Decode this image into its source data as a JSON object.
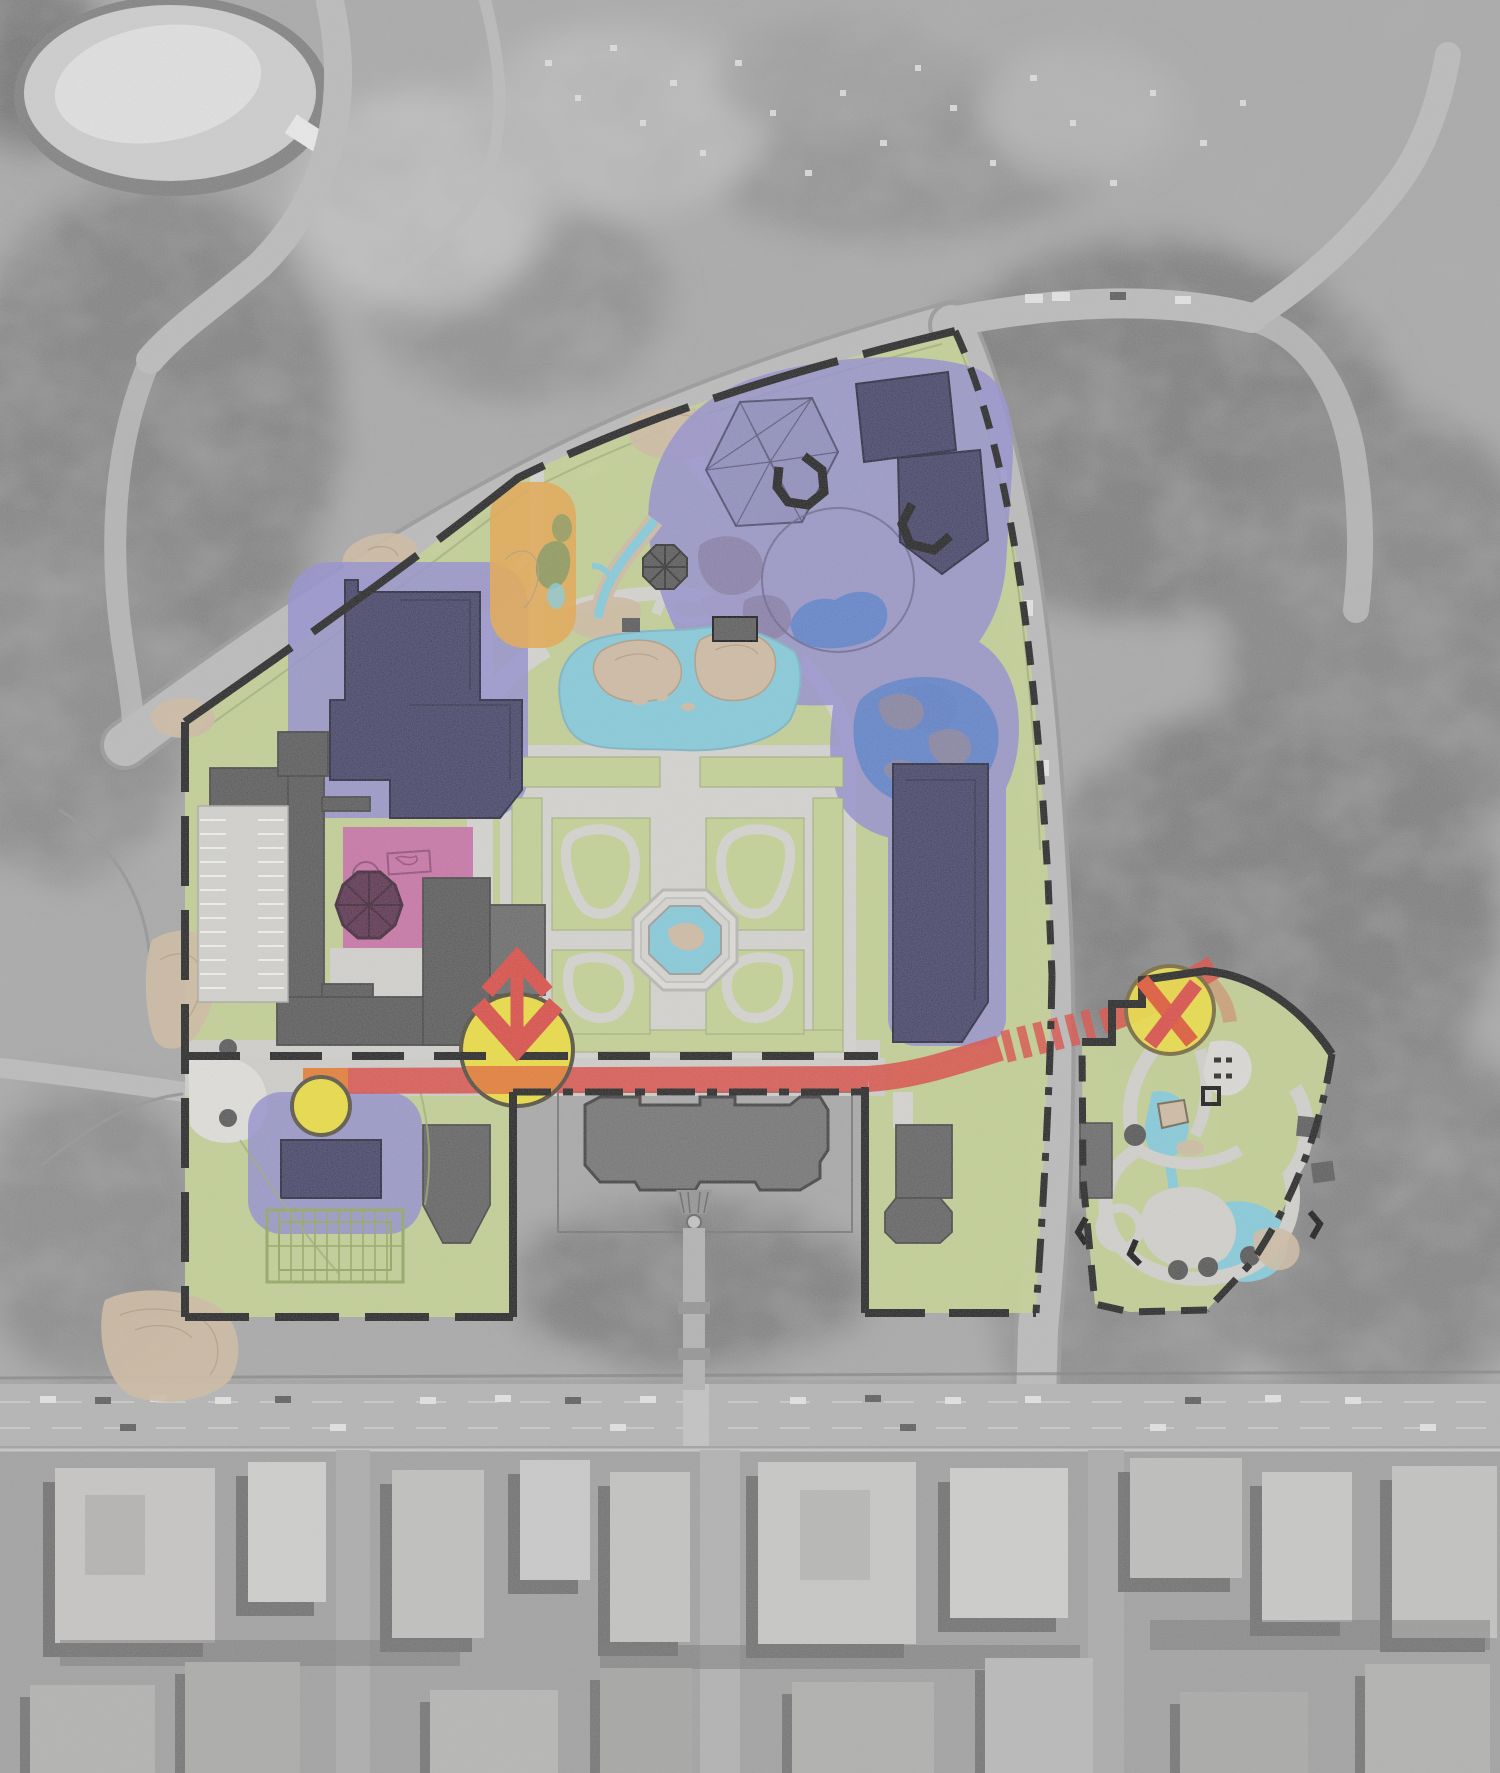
{
  "map": {
    "type": "zoo-master-plan-site-overlay",
    "background": "grayscale-aerial-photograph-of-park-and-city",
    "landmarks": {
      "northwest": "ice-rink-oval",
      "north": "curving-park-drive-with-cars",
      "east": "east-drive-and-tree-canopy",
      "south": "city-street-grid-with-buildings"
    },
    "parcels": [
      {
        "id": "main-zoo-parcel",
        "fill": "site_green",
        "boundary": "black-solid-and-dashed",
        "excluded_area": "arsenal-building-court"
      },
      {
        "id": "childrens-zoo-parcel",
        "fill": "site_green",
        "boundary": "black-dash-dot"
      }
    ],
    "zones": [
      {
        "id": "exhibit-zone-north",
        "color": "zone_purple"
      },
      {
        "id": "exhibit-zone-east-pond",
        "color": "zone_purple"
      },
      {
        "id": "exhibit-zone-southeast",
        "color": "zone_purple"
      },
      {
        "id": "exhibit-zone-west",
        "color": "zone_purple"
      },
      {
        "id": "exhibit-zone-southwest",
        "color": "zone_purple"
      },
      {
        "id": "service-zone",
        "color": "zone_pink"
      },
      {
        "id": "north-entry-zone",
        "color": "zone_orange"
      }
    ],
    "features": [
      {
        "id": "formal-garden-quad",
        "detail": "four-lawn-panels-with-loop-paths-around-central-octagonal-pool"
      },
      {
        "id": "main-lake",
        "color": "water_aqua"
      },
      {
        "id": "aviary-trellis",
        "detail": "triangulated-net-structure"
      },
      {
        "id": "clock-octagon",
        "detail": "dark-octagon-with-spokes"
      },
      {
        "id": "arsenal-building",
        "color": "arsenal_gray"
      },
      {
        "id": "service-buildings-and-parking",
        "color": "building_gray"
      },
      {
        "id": "rock-outcrops",
        "color": "rock_tan"
      },
      {
        "id": "trellis-grid-garden",
        "detail": "rectangular-grid-pergola"
      }
    ],
    "route": {
      "id": "red-spine-path",
      "color": "accent_red",
      "crossing": "hatched-where-crossing-east-drive"
    },
    "markers": [
      {
        "id": "node-marker-west",
        "style": "small-yellow-circle"
      },
      {
        "id": "node-marker-center",
        "style": "yellow-circle-with-red-double-arrow"
      },
      {
        "id": "node-marker-east",
        "style": "yellow-circle-with-red-cross"
      }
    ]
  },
  "colors": {
    "site_green": "#c7d78f",
    "path_gray": "#dbdad5",
    "path_light": "#e8e7e2",
    "water_aqua": "#7ecfe2",
    "pond_blue": "#4a77cf",
    "rock_tan": "#d4bda0",
    "zone_purple": "#8d87d5",
    "building_navy": "#34325c",
    "zone_pink": "#cc60a5",
    "building_maroon": "#4e1f40",
    "zone_orange": "#eda63e",
    "accent_red": "#e23c34",
    "accent_orange": "#ef7420",
    "marker_yellow": "#f6e52f",
    "boundary_black": "#0f0f0f",
    "building_gray": "#4c4c4c",
    "arsenal_gray": "#6a6a6a"
  }
}
